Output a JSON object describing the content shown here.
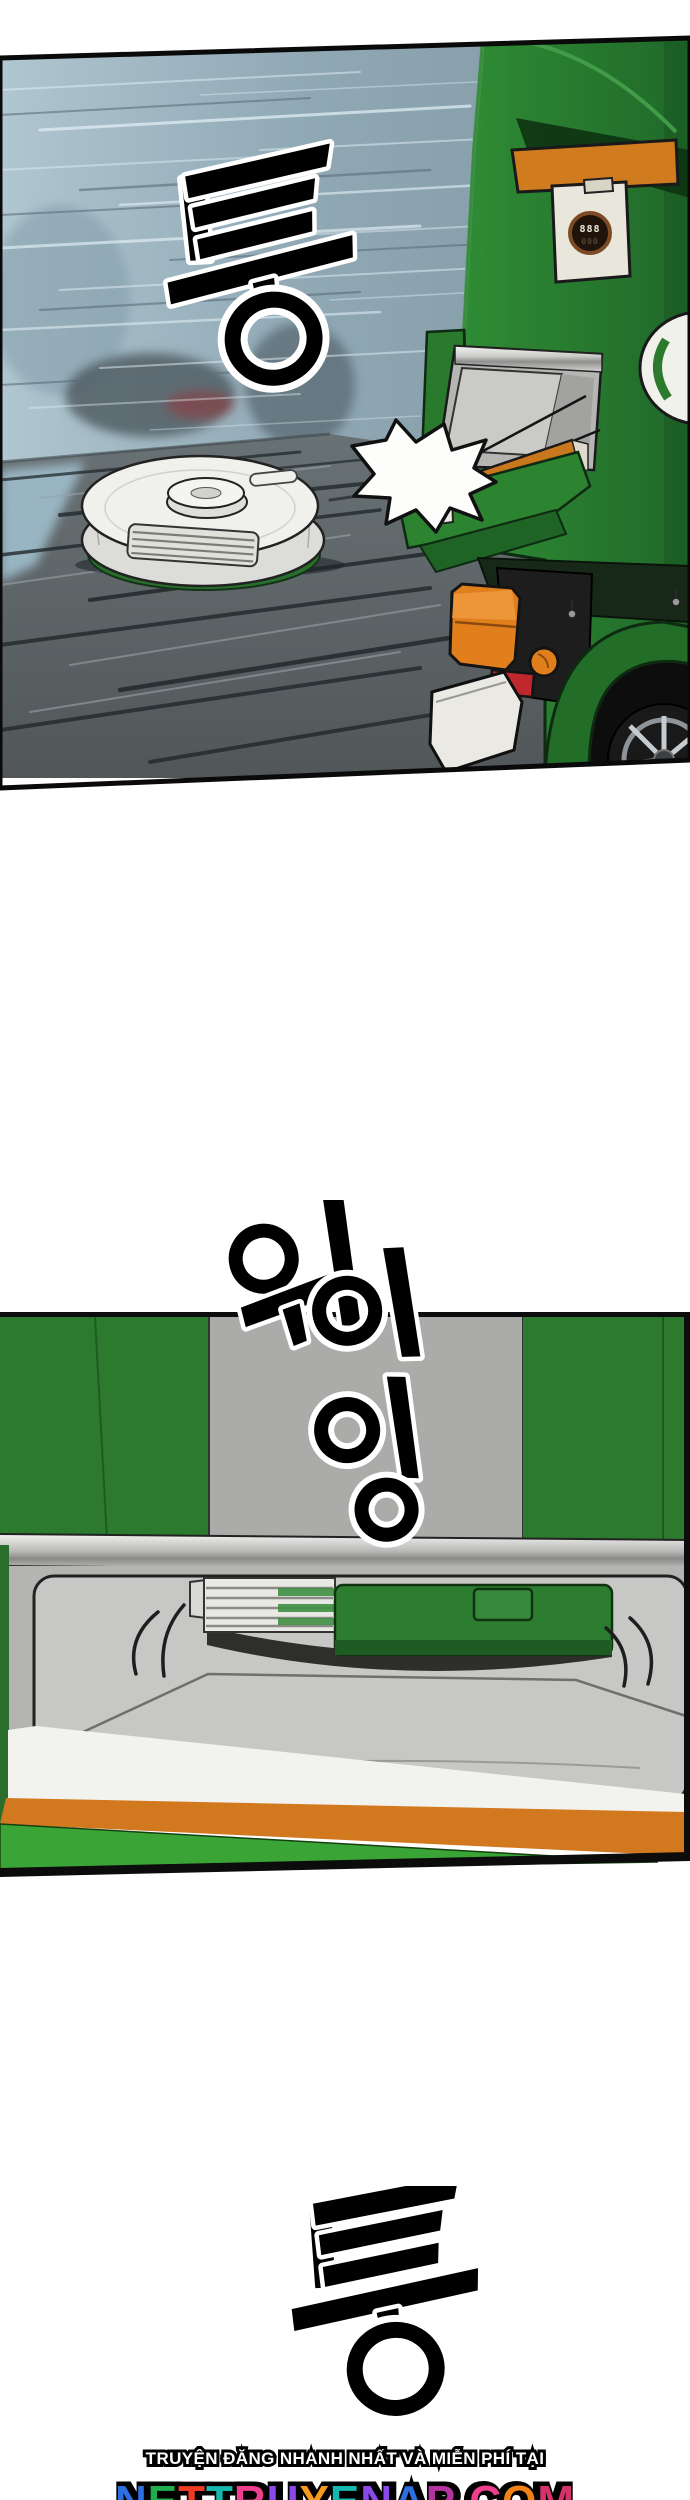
{
  "page": {
    "background": "#ffffff"
  },
  "panel1": {
    "sfx": "퉁",
    "gauge": {
      "top": "888",
      "bottom": "000"
    },
    "colors": {
      "truck_green": "#2b7d2f",
      "truck_orange": "#d07b1e",
      "sky_blue_grey": "#8fa8b4",
      "floor_grey": "#5c6568",
      "tail_light_orange": "#e07f1c",
      "reflector_red": "#c1282e",
      "vacuum_white": "#f0f0ed"
    }
  },
  "panel2": {
    "sfx": "위이잉",
    "sfx_glyphs": [
      "위",
      "이",
      "잉"
    ],
    "colors": {
      "wall_green": "#2b7a2e",
      "column_grey": "#ababa9",
      "band_orange": "#d2791f",
      "wedge_green": "#3aa437",
      "interior_grey": "#c7c7c5",
      "metal_silver": "#c9c9c7"
    }
  },
  "sfx_bottom": "퉁",
  "footer": {
    "tagline": "TRUYỆN ĐĂNG NHANH NHẤT VÀ MIỄN PHÍ TẠI",
    "site_name": "NETTRUYENAP.COM",
    "site_colors": [
      "#2e6fe0",
      "#1fae4e",
      "#ef3b23",
      "#16b8ae",
      "#ee3f8e",
      "#8a49e8",
      "#f59a1a",
      "#16b8ae",
      "#8a49e8",
      "#2e6fe0",
      "#b3349f",
      "#222222",
      "#ee3f8e",
      "#f08118",
      "#d6336c"
    ]
  }
}
